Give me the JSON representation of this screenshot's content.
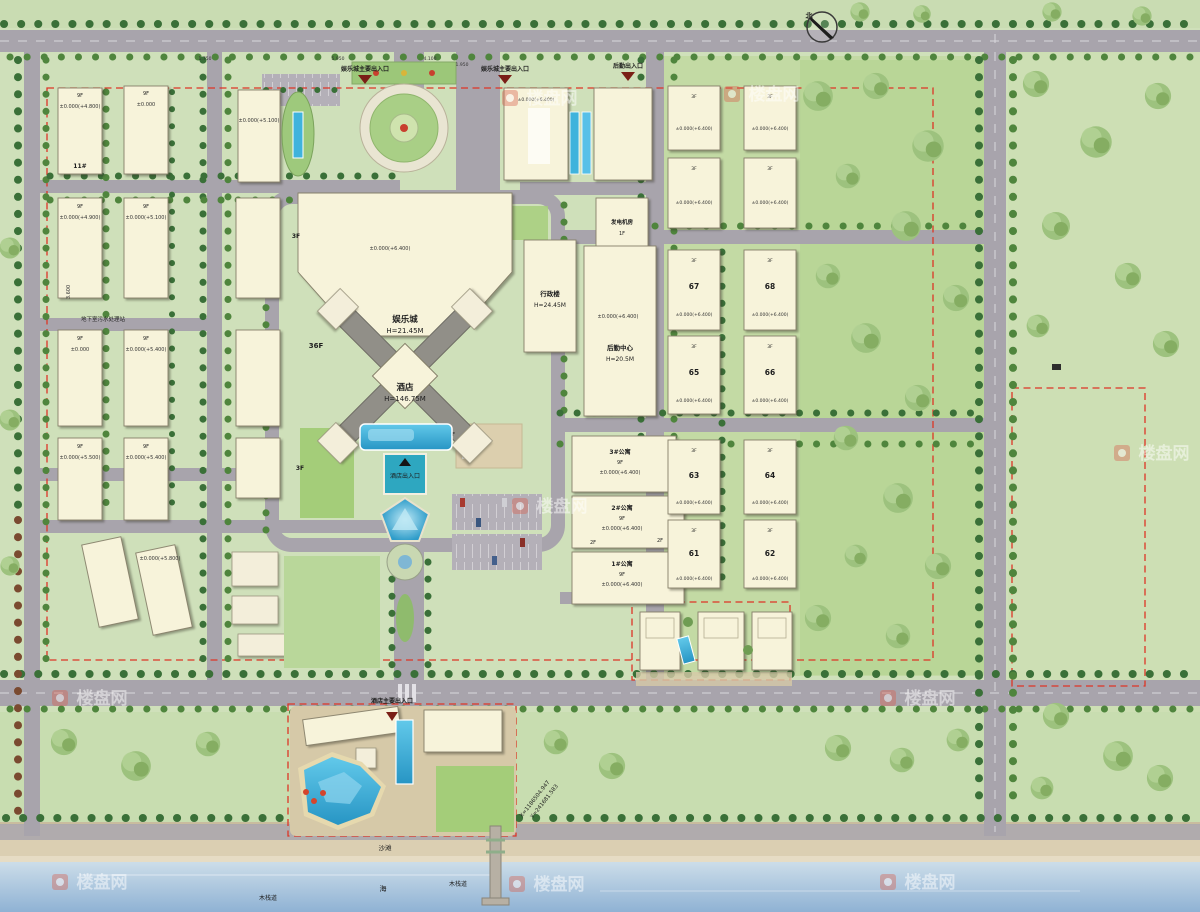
{
  "palette": {
    "road": "#a8a4ac",
    "building": "#f7f3da",
    "lawn": "#b9d79a",
    "base": "#cfe0ba",
    "sand": "#dbcfb2",
    "sea": "#8fb2d4",
    "pool": "#3eb1de",
    "boundary_red": "#dd3526",
    "tree_green": "#3a7038"
  },
  "north_label": "北",
  "watermark_text": "楼盘网",
  "entrances": {
    "top_left": "娱乐城主要出入口",
    "top_center": "娱乐城主要出入口",
    "top_right": "后勤出入口",
    "hotel": "酒店出入口",
    "beach_main": "酒店主要出入口"
  },
  "dims": {
    "d1": "1.750",
    "d2": "5.950",
    "d3": "4.100",
    "d4": "1.950",
    "d5": "3.600"
  },
  "common": {
    "f1": "1F",
    "f2": "2F",
    "f3": "3F",
    "f9": "9F",
    "f36": "36F",
    "elev64": "±0.000(+6.400)"
  },
  "center": {
    "entertainment": {
      "name": "娱乐城",
      "height": "H=21.45M"
    },
    "hotel": {
      "name": "酒店",
      "height": "H=146.75M"
    }
  },
  "east": {
    "generator": "发电机房",
    "admin": {
      "name": "行政楼",
      "height": "H=24.45M"
    },
    "logistics": {
      "name": "后勤中心",
      "height": "H=20.5M"
    },
    "apartments": [
      {
        "name": "3#公寓"
      },
      {
        "name": "2#公寓"
      },
      {
        "name": "1#公寓"
      }
    ],
    "blocks": [
      {
        "no": "67"
      },
      {
        "no": "68"
      },
      {
        "no": "65"
      },
      {
        "no": "66"
      },
      {
        "no": "63"
      },
      {
        "no": "64"
      },
      {
        "no": "61"
      },
      {
        "no": "62"
      }
    ]
  },
  "west": {
    "sewage": "地下室污水处理站",
    "b11": "11#",
    "elevations": {
      "a1": "±0.000(+4.800)",
      "b1": "±0.000",
      "a2": "±0.000(+4.900)",
      "b2": "±0.000(+5.100)",
      "a3": "±0.000",
      "b3": "±0.000(+5.400)",
      "a4": "±0.000(+5.500)",
      "b4": "±0.000(+5.400)",
      "c1": "±0.000(+5.100)",
      "d": "±0.000(+5.800)"
    }
  },
  "south": {
    "beach": "沙滩",
    "sea": "海",
    "boardwalk_left": "木栈道",
    "boardwalk_right": "木栈道",
    "coord_x": "X=1186504.947",
    "coord_y": "Y=241681.583"
  }
}
